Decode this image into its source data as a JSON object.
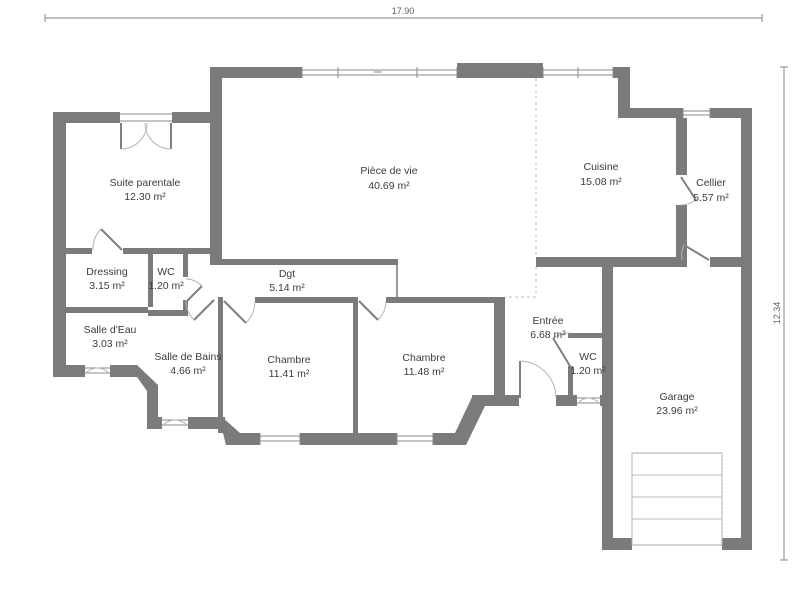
{
  "plan": {
    "title": "floor-plan",
    "dimensions": {
      "width_label": "17.90",
      "height_label": "12.34"
    },
    "colors": {
      "wall": "#7b7b7b",
      "symbol": "#8f8f8f",
      "text": "#3c3c3c"
    },
    "rooms": [
      {
        "name": "Suite parentale",
        "area": "12.30 m²"
      },
      {
        "name": "Pièce de vie",
        "area": "40.69 m²"
      },
      {
        "name": "Cuisine",
        "area": "15.08 m²"
      },
      {
        "name": "Cellier",
        "area": "5.57 m²"
      },
      {
        "name": "Dressing",
        "area": "3.15 m²"
      },
      {
        "name": "WC",
        "area": "1.20 m²"
      },
      {
        "name": "Dgt",
        "area": "5.14 m²"
      },
      {
        "name": "Salle d'Eau",
        "area": "3.03 m²"
      },
      {
        "name": "Salle de Bains",
        "area": "4.66 m²"
      },
      {
        "name": "Chambre",
        "area": "11.41 m²"
      },
      {
        "name": "Chambre",
        "area": "11.48 m²"
      },
      {
        "name": "Entrée",
        "area": "6.68 m²"
      },
      {
        "name": "WC",
        "area": "1.20 m²"
      },
      {
        "name": "Garage",
        "area": "23.96 m²"
      }
    ]
  }
}
